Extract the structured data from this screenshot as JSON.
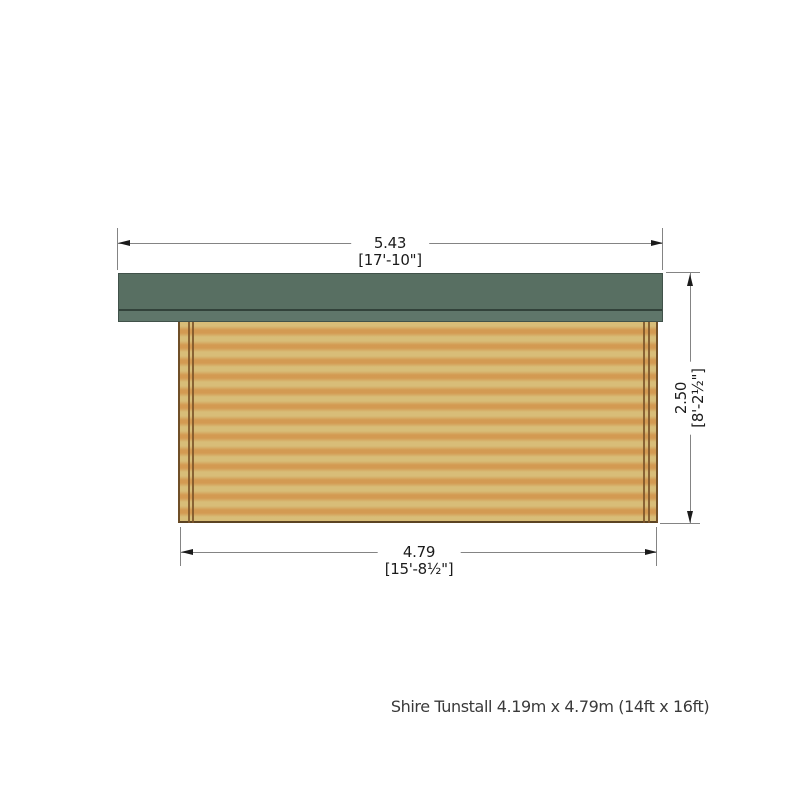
{
  "caption": "Shire Tunstall 4.19m x 4.79m (14ft x 16ft)",
  "dimensions": {
    "roof_width": {
      "metric": "5.43",
      "imperial": "[17'-10\"]"
    },
    "wall_width": {
      "metric": "4.79",
      "imperial": "[15'-8½\"]"
    },
    "wall_height": {
      "metric": "2.50",
      "imperial": "[8'-2½\"]"
    }
  },
  "colors": {
    "roof_main": "#586f62",
    "roof_fascia": "#5f766a",
    "roof_edge_line": "#32423a",
    "roof_outline": "#41524a",
    "wall_light": "#d8bd78",
    "wall_dark": "#d39a52",
    "wall_trim": "#6f4f28",
    "wall_trim_dark": "#5c4322",
    "post_line": "#7b5328",
    "dimension_line": "#848484",
    "text": "#1b1b1b",
    "caption_text": "#3a3a3a"
  }
}
